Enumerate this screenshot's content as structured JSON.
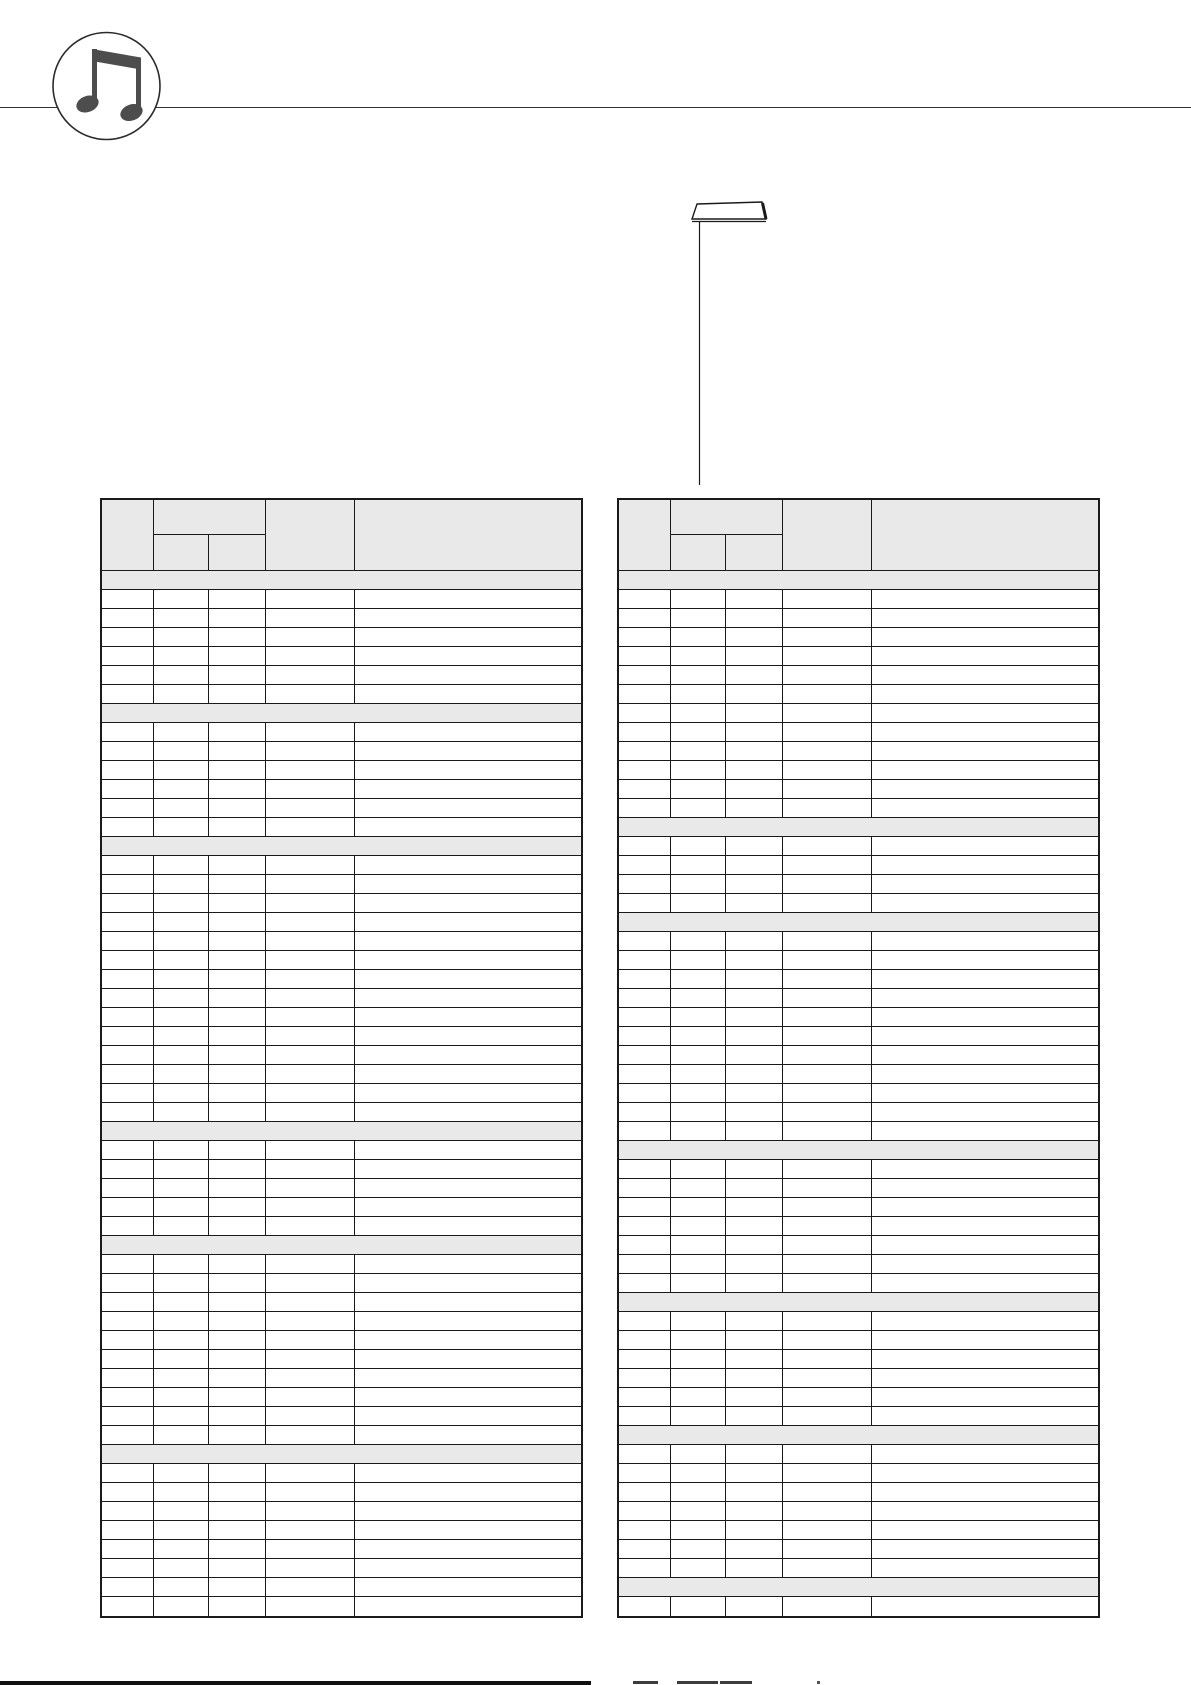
{
  "page": {
    "width": 1191,
    "height": 1685,
    "background": "#ffffff"
  },
  "colors": {
    "table_border": "#1a1a1a",
    "section_row_fill": "#e9e9e9",
    "header_row_fill": "#e9e9e9",
    "icon_color": "#4d4d4d",
    "top_rule_color": "#333333",
    "footer_bar_color": "#111111"
  },
  "logo": {
    "icon": "beamed-eighth-notes-icon",
    "shape": "circle-badge"
  },
  "callout": {
    "icon": "panel-key-icon",
    "pointer_line": "vertical-leader-to-right-table"
  },
  "tables": [
    {
      "name": "left-voice-table",
      "columns": [
        {
          "key": "col1",
          "label": "",
          "width": 52
        },
        {
          "key": "col2a",
          "label": "",
          "width": 55,
          "group": "col2"
        },
        {
          "key": "col2b",
          "label": "",
          "width": 57,
          "group": "col2"
        },
        {
          "key": "col3",
          "label": "",
          "width": 89
        },
        {
          "key": "col4",
          "label": "",
          "width": 230
        }
      ],
      "header_labels": {
        "col1": "",
        "col2_group": "",
        "col2a": "",
        "col2b": "",
        "col3": "",
        "col4": ""
      },
      "sections": [
        {
          "label": "",
          "rows": 6
        },
        {
          "label": "",
          "rows": 6
        },
        {
          "label": "",
          "rows": 14
        },
        {
          "label": "",
          "rows": 5
        },
        {
          "label": "",
          "rows": 10
        },
        {
          "label": "",
          "rows": 8
        }
      ],
      "cell_values": "all-blank"
    },
    {
      "name": "right-voice-table",
      "columns": [
        {
          "key": "col1",
          "label": "",
          "width": 52
        },
        {
          "key": "col2a",
          "label": "",
          "width": 55,
          "group": "col2"
        },
        {
          "key": "col2b",
          "label": "",
          "width": 57,
          "group": "col2"
        },
        {
          "key": "col3",
          "label": "",
          "width": 89
        },
        {
          "key": "col4",
          "label": "",
          "width": 230
        }
      ],
      "header_labels": {
        "col1": "",
        "col2_group": "",
        "col2a": "",
        "col2b": "",
        "col3": "",
        "col4": ""
      },
      "sections": [
        {
          "label": "",
          "rows": 12
        },
        {
          "label": "",
          "rows": 4
        },
        {
          "label": "",
          "rows": 11
        },
        {
          "label": "",
          "rows": 7
        },
        {
          "label": "",
          "rows": 6
        },
        {
          "label": "",
          "rows": 7
        },
        {
          "label": "",
          "rows": 1
        }
      ],
      "cell_values": "all-blank"
    }
  ],
  "footer": {
    "bar": "thick-black-rule",
    "text": "",
    "note": "unreadable text sliver cut off at page bottom"
  }
}
